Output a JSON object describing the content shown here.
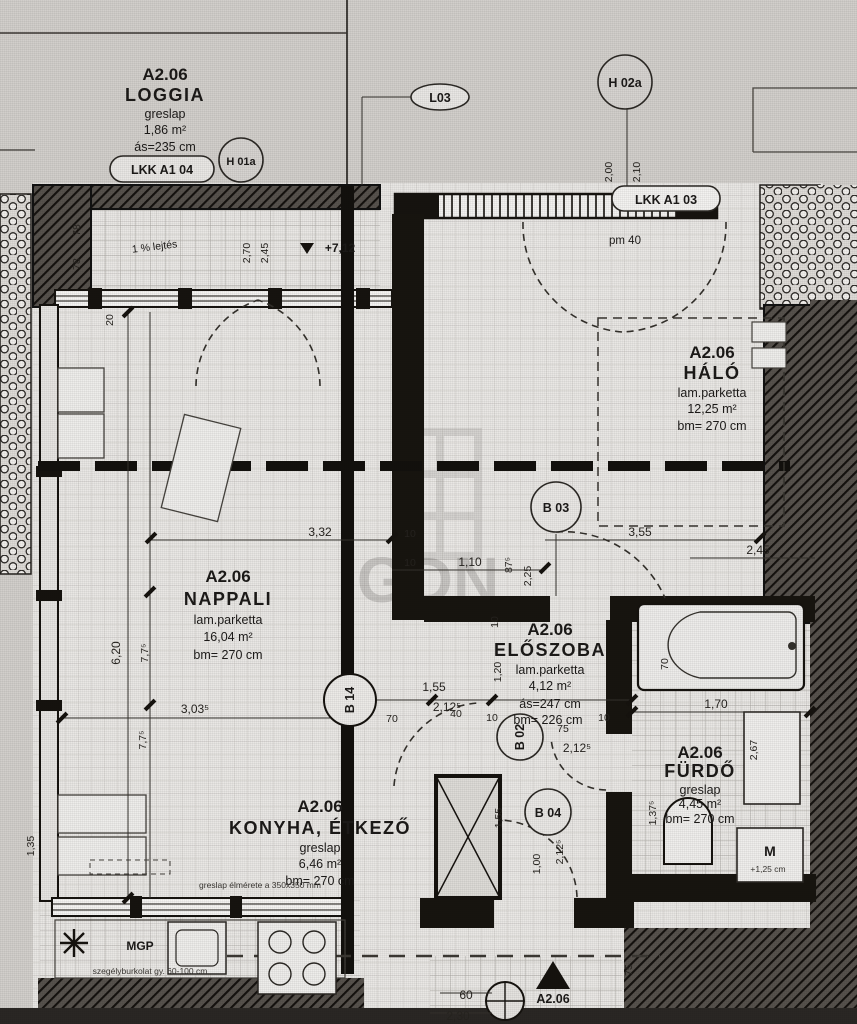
{
  "loggia": {
    "code": "A2.06",
    "name": "LOGGIA",
    "finish": "greslap",
    "area": "1,86 m²",
    "height": "ás=235 cm"
  },
  "nappali": {
    "code": "A2.06",
    "name": "NAPPALI",
    "finish": "lam.parketta",
    "area": "16,04 m²",
    "height": "bm= 270 cm"
  },
  "halo": {
    "code": "A2.06",
    "name": "HÁLÓ",
    "finish": "lam.parketta",
    "area": "12,25 m²",
    "height": "bm= 270 cm"
  },
  "eloszoba": {
    "code": "A2.06",
    "name": "ELŐSZOBA",
    "finish": "lam.parketta",
    "area": "4,12 m²",
    "height": "ás=247 cm",
    "height2": "bm= 226 cm"
  },
  "furdo": {
    "code": "A2.06",
    "name": "FÜRDŐ",
    "finish": "greslap",
    "area": "4,45 m²",
    "height": "bm= 270 cm"
  },
  "konyha": {
    "code": "A2.06",
    "name": "KONYHA, ÉTKEZŐ",
    "finish": "greslap",
    "area": "6,46 m²",
    "height": "bm= 270 cm"
  },
  "tags": {
    "lkk04": "LKK A1 04",
    "lkk03": "LKK A1 03",
    "l03": "L03",
    "h01a": "H 01a",
    "h02a": "H 02a",
    "b03": "B 03",
    "b14": "B 14",
    "b02": "B 02",
    "b04": "B 04"
  },
  "annotations": {
    "pm40": "pm 40",
    "level": "+7,12",
    "slope": "1 % lejtés",
    "mgp": "MGP",
    "m": "M",
    "m_note": "+1,25 cm",
    "entrance_code": "A2.06",
    "kitchen_note": "greslap élmérete a 350x350 mm",
    "plinth_note": "szegélyburkolat gy. 60-100 cm",
    "watermark": "GDN"
  },
  "dims": {
    "d78a": "78",
    "d78b": "78",
    "d20": "20",
    "d270": "2,70",
    "d245": "2,45",
    "d200": "2,00",
    "d210": "2,10",
    "d332": "3,32",
    "d10a": "10",
    "d10b": "10",
    "d110": "1,10",
    "d875": "87⁵",
    "d225": "2,25",
    "d355": "3,55",
    "d245b": "2,45",
    "d620": "6,20",
    "d775a": "7,7⁵",
    "d775b": "7,7⁵",
    "d3035": "3,03⁵",
    "d155": "1,55",
    "d2125a": "2,12⁵",
    "d70": "70",
    "d40": "40",
    "d10c": "10",
    "d10d": "10",
    "d75": "75",
    "d2125b": "2,12⁵",
    "d10e": "10",
    "d120": "1,20",
    "d155b": "1,55",
    "d100": "1,00",
    "d2125c": "2,12⁵",
    "d135": "1,35",
    "d170": "1,70",
    "d1375": "1,37⁵",
    "d267": "2,67",
    "d70b": "70",
    "d60": "60",
    "d230": "2,30",
    "d75b": "75"
  }
}
